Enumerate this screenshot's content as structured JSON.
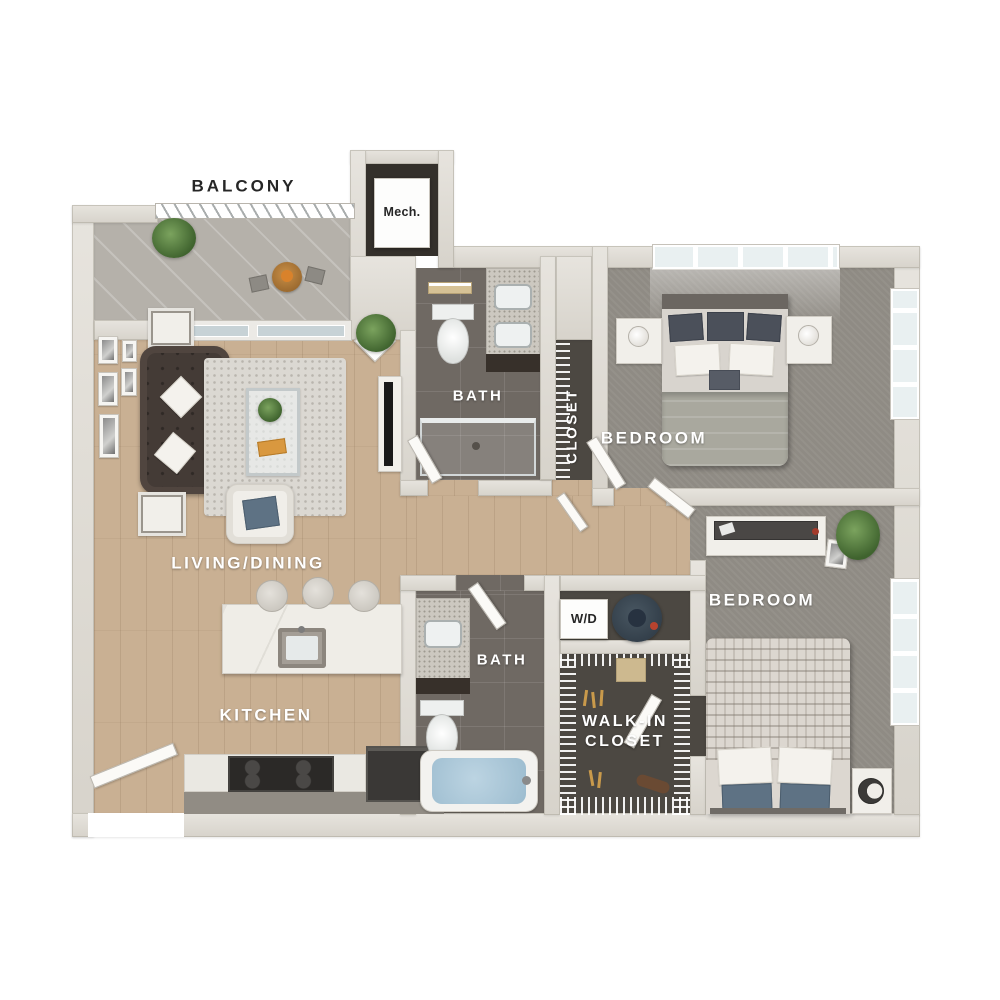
{
  "floorplan": {
    "rooms": {
      "balcony": {
        "label": "BALCONY"
      },
      "mech": {
        "label": "Mech."
      },
      "bath_upper": {
        "label": "BATH"
      },
      "closet": {
        "label": "CLOSET"
      },
      "bedroom_upper": {
        "label": "BEDROOM"
      },
      "living_dining": {
        "label": "LIVING/DINING"
      },
      "kitchen": {
        "label": "KITCHEN"
      },
      "bath_lower": {
        "label": "BATH"
      },
      "laundry": {
        "label": "W/D"
      },
      "walk_in_closet": {
        "label": "WALK-IN CLOSET"
      },
      "bedroom_lower": {
        "label": "BEDROOM"
      }
    },
    "colors": {
      "background": "#ffffff",
      "wall": "#d7d3cb",
      "wood_floor": "#c9b093",
      "carpet": "#8f8b84",
      "bath_tile": "#6f6963",
      "closet_floor": "#4c4842",
      "balcony_floor": "#b5b1aa",
      "label_light": "#ffffff",
      "label_dark": "#262626",
      "sofa": "#443b36",
      "water": "#a9c6d6",
      "plant": "#5c8a4e",
      "appliance_dark": "#3e4a54"
    }
  }
}
